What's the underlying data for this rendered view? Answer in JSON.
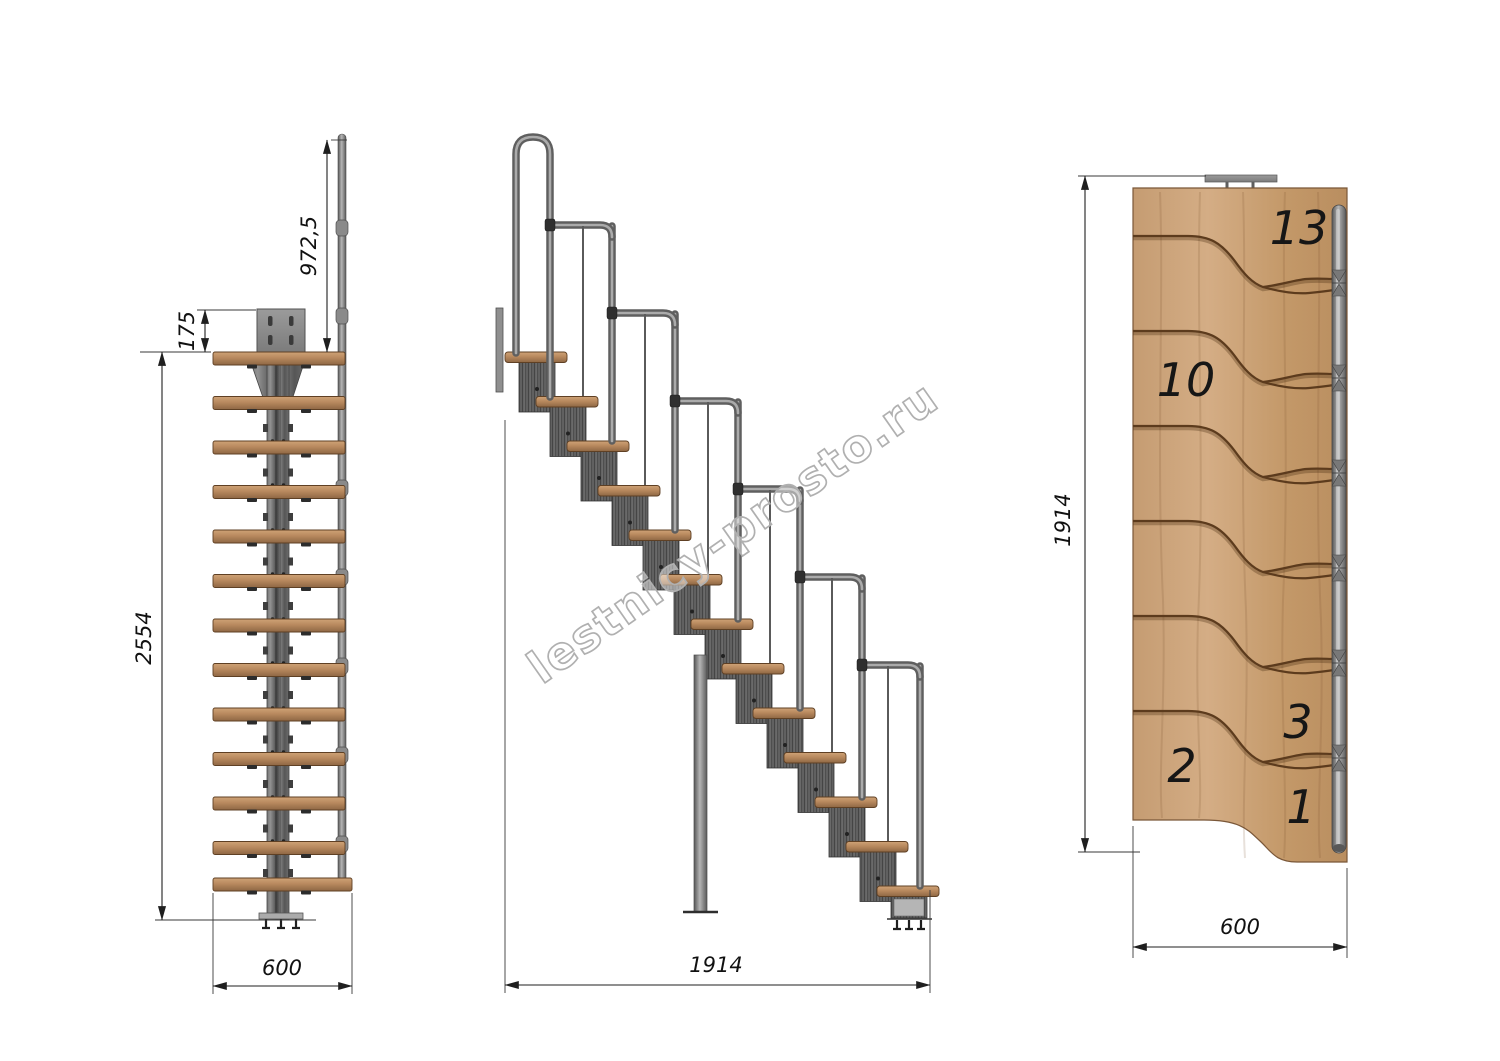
{
  "watermark": {
    "text": "lestnicy-prosto.ru"
  },
  "views": {
    "front": {
      "tread_count": 13,
      "dims": {
        "handrail_height": "972,5",
        "top_plate_offset": "175",
        "total_height": "2554",
        "width": "600"
      }
    },
    "side": {
      "step_count": 13,
      "dims": {
        "total_run": "1914"
      }
    },
    "plan": {
      "dims": {
        "length": "1914",
        "width": "600"
      },
      "tread_numbers": [
        "13",
        "10",
        "3",
        "2",
        "1"
      ]
    }
  },
  "colors": {
    "background": "#ffffff",
    "wood": "#b8895e",
    "wood_plan": "#cda47c",
    "metal": "#6e6e6e",
    "metal_dark": "#454545",
    "dimension_line": "#1f1f1f",
    "watermark_gray": "#b0b0b0"
  }
}
